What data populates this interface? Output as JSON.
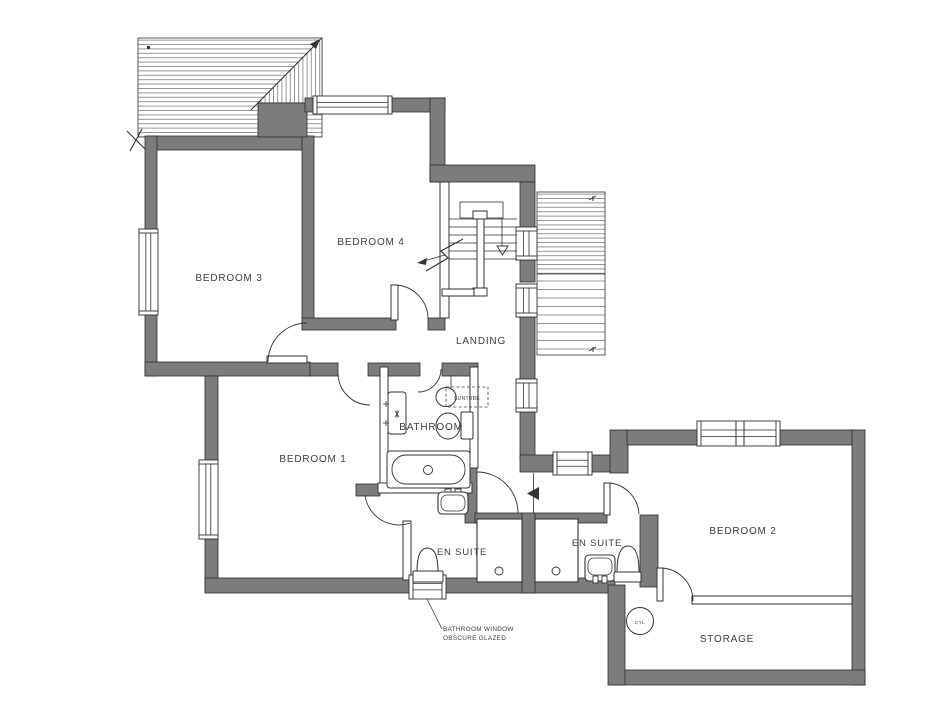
{
  "drawing": {
    "kind": "architectural-floor-plan"
  },
  "colors": {
    "background": "#ffffff",
    "wall_fill": "#7c7c7c",
    "wall_stroke": "#2b2b2b",
    "line": "#333333",
    "hatch": "#6a6a6a",
    "text": "#3d3d3d"
  },
  "rooms": [
    {
      "id": "bedroom-3",
      "label": "BEDROOM 3",
      "x": 229,
      "y": 281,
      "fs": 10
    },
    {
      "id": "bedroom-4",
      "label": "BEDROOM 4",
      "x": 371,
      "y": 245,
      "fs": 10
    },
    {
      "id": "landing",
      "label": "LANDING",
      "x": 481,
      "y": 344,
      "fs": 10
    },
    {
      "id": "bedroom-1",
      "label": "BEDROOM 1",
      "x": 313,
      "y": 462,
      "fs": 10
    },
    {
      "id": "bathroom",
      "label": "BATHROOM",
      "x": 431,
      "y": 430,
      "fs": 10
    },
    {
      "id": "en-suite-1",
      "label": "EN SUITE",
      "x": 462,
      "y": 555,
      "fs": 9.5
    },
    {
      "id": "en-suite-2",
      "label": "EN SUITE",
      "x": 597,
      "y": 546,
      "fs": 9.5
    },
    {
      "id": "bedroom-2",
      "label": "BEDROOM 2",
      "x": 743,
      "y": 534,
      "fs": 10
    },
    {
      "id": "storage",
      "label": "STORAGE",
      "x": 727,
      "y": 642,
      "fs": 10
    }
  ],
  "annotations": [
    {
      "id": "suntube-label",
      "label": "SUNTUBE",
      "x": 467,
      "y": 400,
      "fs": 5,
      "anchor": "middle"
    },
    {
      "id": "cylinder-label",
      "label": "CYL",
      "x": 640,
      "y": 624,
      "fs": 4.8,
      "anchor": "middle"
    },
    {
      "id": "window-note-1",
      "label": "BATHROOM WINDOW",
      "x": 443,
      "y": 631,
      "fs": 6.4,
      "anchor": "start"
    },
    {
      "id": "window-note-2",
      "label": "OBSCURE GLAZED",
      "x": 443,
      "y": 640,
      "fs": 6.4,
      "anchor": "start"
    }
  ],
  "fixtures": [
    "bathtub",
    "wash-basin-bathroom",
    "wc-bathroom",
    "radiator",
    "wash-basin-ensuite-1",
    "wc-ensuite-1",
    "shower-tray-ensuite-1",
    "wash-basin-ensuite-2",
    "wc-ensuite-2",
    "shower-tray-ensuite-2",
    "hot-water-cylinder",
    "staircase",
    "suntube-rooflight"
  ]
}
